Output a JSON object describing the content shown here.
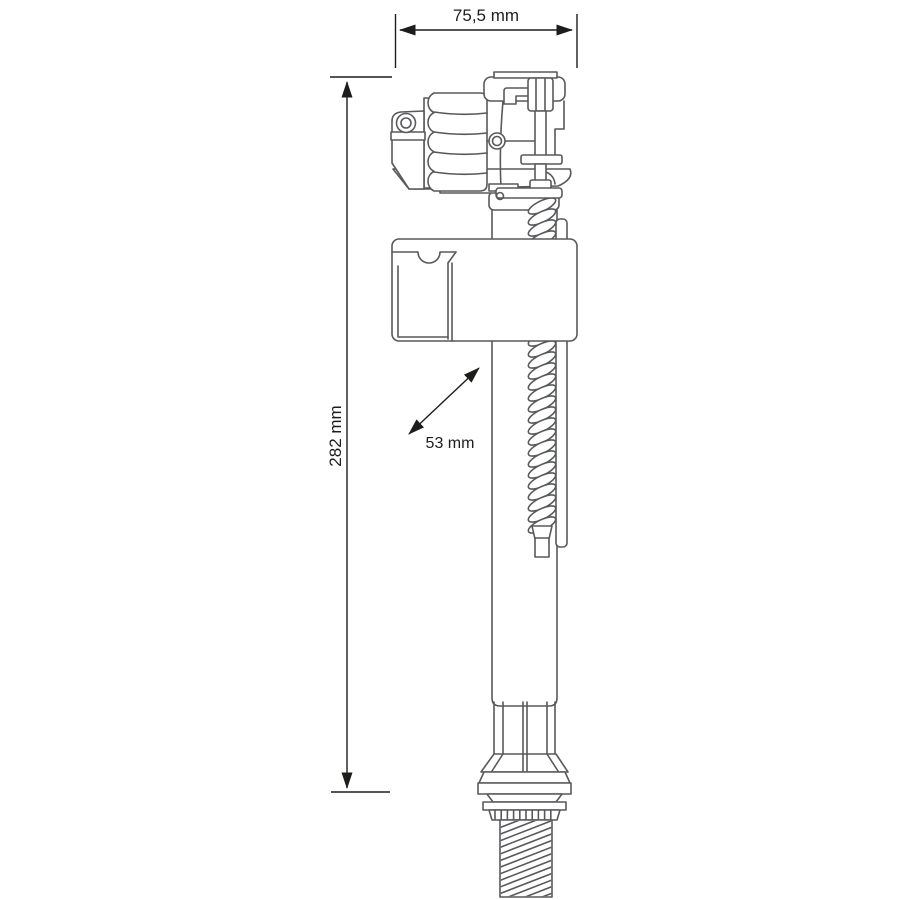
{
  "colors": {
    "background": "#ffffff",
    "drawing_stroke": "#58595b",
    "dimension_color": "#1d1d1b"
  },
  "diagram": {
    "type": "technical-drawing",
    "subject": "Bottom-entry toilet cistern fill valve, side elevation with dimensions",
    "dimensions": {
      "head_width": {
        "label": "75,5 mm",
        "value": 75.5,
        "unit": "mm",
        "orientation": "horizontal"
      },
      "overall_height": {
        "label": "282 mm",
        "value": 282,
        "unit": "mm",
        "orientation": "vertical"
      },
      "float_diagonal": {
        "label": "53 mm",
        "value": 53,
        "unit": "mm",
        "orientation": "diagonal"
      }
    }
  }
}
